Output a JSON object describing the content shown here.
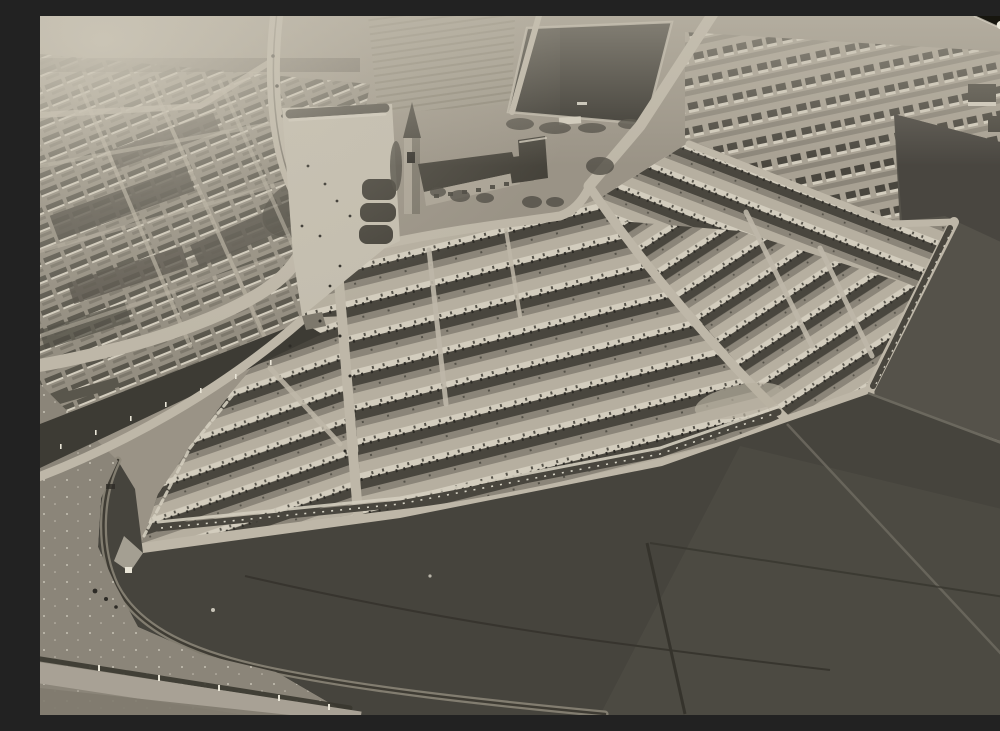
{
  "image": {
    "kind": "monochrome-oblique-aerial-photograph-of-housing-estate",
    "width_px": 1000,
    "height_px": 699
  },
  "palette": {
    "base": "#9a9386",
    "street": "#b6afa0",
    "facade": "#d3cdbe",
    "window": "#545148",
    "roof": "#49463e",
    "chimney": "#2d2b26",
    "yard": "#8b8579",
    "town_bg": "#948e81",
    "town_roof": "#59564c",
    "town_yard": "#7d786c",
    "villa_bg": "#a8a193",
    "allot_a": "#9b9587",
    "allot_b": "#868071",
    "plaza": "#c4beaf",
    "road": "#beb7a8",
    "tram_strip": "#3d3b34",
    "tree": "#4b4840",
    "pitch": "#34322c",
    "field_south": "#46443d",
    "field_east": "#55524a",
    "field_line_dark": "#35332c",
    "field_line_light": "#6b685e",
    "rough": "#8b8579",
    "band": "#a8a195",
    "hedge": "#39372f",
    "below_band": "#7f7a6e",
    "arc_light": "#8d8779",
    "arc_dark": "#3f3c34",
    "white_dot": "#e9e5d7",
    "paper_edge": "#b3ac9f",
    "wedge": "#17160f",
    "hole": "#ece8da",
    "haze": "#cfc9ba",
    "church_wall": "#aba496",
    "church_roof": "#45423a",
    "shade": "#7d786c",
    "block": "#524f46"
  },
  "regions": [
    {
      "name": "old-town-grid"
    },
    {
      "name": "tree-lined-avenue"
    },
    {
      "name": "sports-pitch"
    },
    {
      "name": "allotment-strips"
    },
    {
      "name": "villa-rows-north-east"
    },
    {
      "name": "church-with-spire"
    },
    {
      "name": "plaza-with-garden-beds"
    },
    {
      "name": "tram-reservation-strip"
    },
    {
      "name": "terraced-estate-central"
    },
    {
      "name": "terraced-estate-west"
    },
    {
      "name": "terraced-estate-east"
    },
    {
      "name": "boundary-road-south"
    },
    {
      "name": "dark-farm-fields"
    },
    {
      "name": "curving-dike-arc"
    },
    {
      "name": "canal-band-bottom-left"
    },
    {
      "name": "photo-corner-mount"
    },
    {
      "name": "photo-paper-edge"
    }
  ]
}
